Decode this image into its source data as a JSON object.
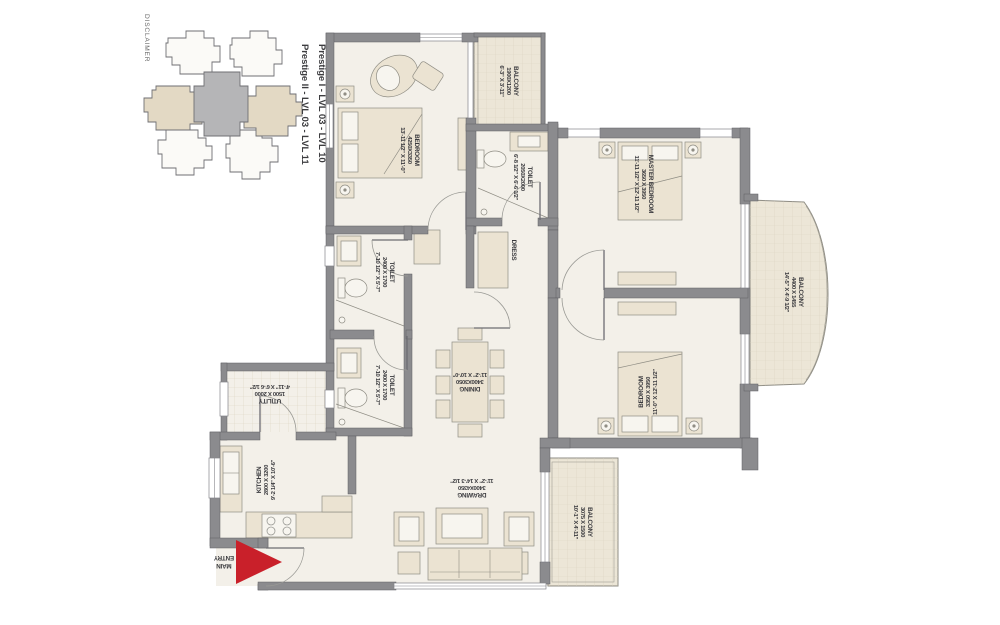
{
  "colors": {
    "arrow_red": "#c9202a",
    "floor": "#f3f0e9",
    "wall": "#8b8b8e",
    "furniture": "#ebe3d2",
    "balcony": "#ece6d7",
    "keyplan_highlight": "#e3d9c4",
    "keyplan_core": "#b5b5b7"
  },
  "disclaimer": "DISCLAIMER",
  "keyplan": {
    "caption_line1": "Prestige I - LVL 03 - LVL 10",
    "caption_line2": "Prestige II - LVL 03 - LVL 11"
  },
  "rooms": {
    "bedroom1": {
      "name": "BEDROOM",
      "metric": "4250X3350",
      "imperial": "13'-11 1/2\" X 11'-0\""
    },
    "balcony_top": {
      "name": "BALCONY",
      "metric": "1900X1200",
      "imperial": "6'-3\" X 3'-11\""
    },
    "toilet_top": {
      "name": "TOILET",
      "metric": "2050X2000",
      "imperial": "6'-8 1/2\" X 6'-6 1/2\""
    },
    "master_bedroom": {
      "name": "MASTER BEDROOM",
      "metric": "3650 X 3950",
      "imperial": "11'-11 1/2\" X 12'-11 1/2\""
    },
    "dress": {
      "name": "DRESS"
    },
    "balcony_right": {
      "name": "BALCONY",
      "metric": "4400 X 1455",
      "imperial": "14'-5\" X 4'-9 1/2\""
    },
    "bedroom2": {
      "name": "BEDROOM",
      "metric": "3350 X 3950",
      "imperial": "11'-0\" X 12'-11 1/2\""
    },
    "balcony_bottom": {
      "name": "BALCONY",
      "metric": "3075 X 1500",
      "imperial": "10'-1\" X 4'-11\""
    },
    "toilet_mid": {
      "name": "TOILET",
      "metric": "2400 X 1700",
      "imperial": "7'-10 1/2\" X 5'-7\""
    },
    "toilet_low": {
      "name": "TOILET",
      "metric": "2400 X 1700",
      "imperial": "7'-10 1/2\" X 5'-7\""
    },
    "dining": {
      "name": "DINING",
      "metric": "3400X3050",
      "imperial": "11'-2\" X 10'-0\""
    },
    "drawing": {
      "name": "DRAWING",
      "metric": "3400X4350",
      "imperial": "11'-2\" X 14'-3 1/2\""
    },
    "utility": {
      "name": "UTILITY",
      "metric": "1500 X 2000",
      "imperial": "4'-11\" X 6'-6 1/2\""
    },
    "kitchen": {
      "name": "KITCHEN",
      "metric": "2800 X 3200",
      "imperial": "9'-2 1/4\" X 10'-6\""
    },
    "main_entry": {
      "line1": "MAIN",
      "line2": "ENTRY"
    }
  }
}
